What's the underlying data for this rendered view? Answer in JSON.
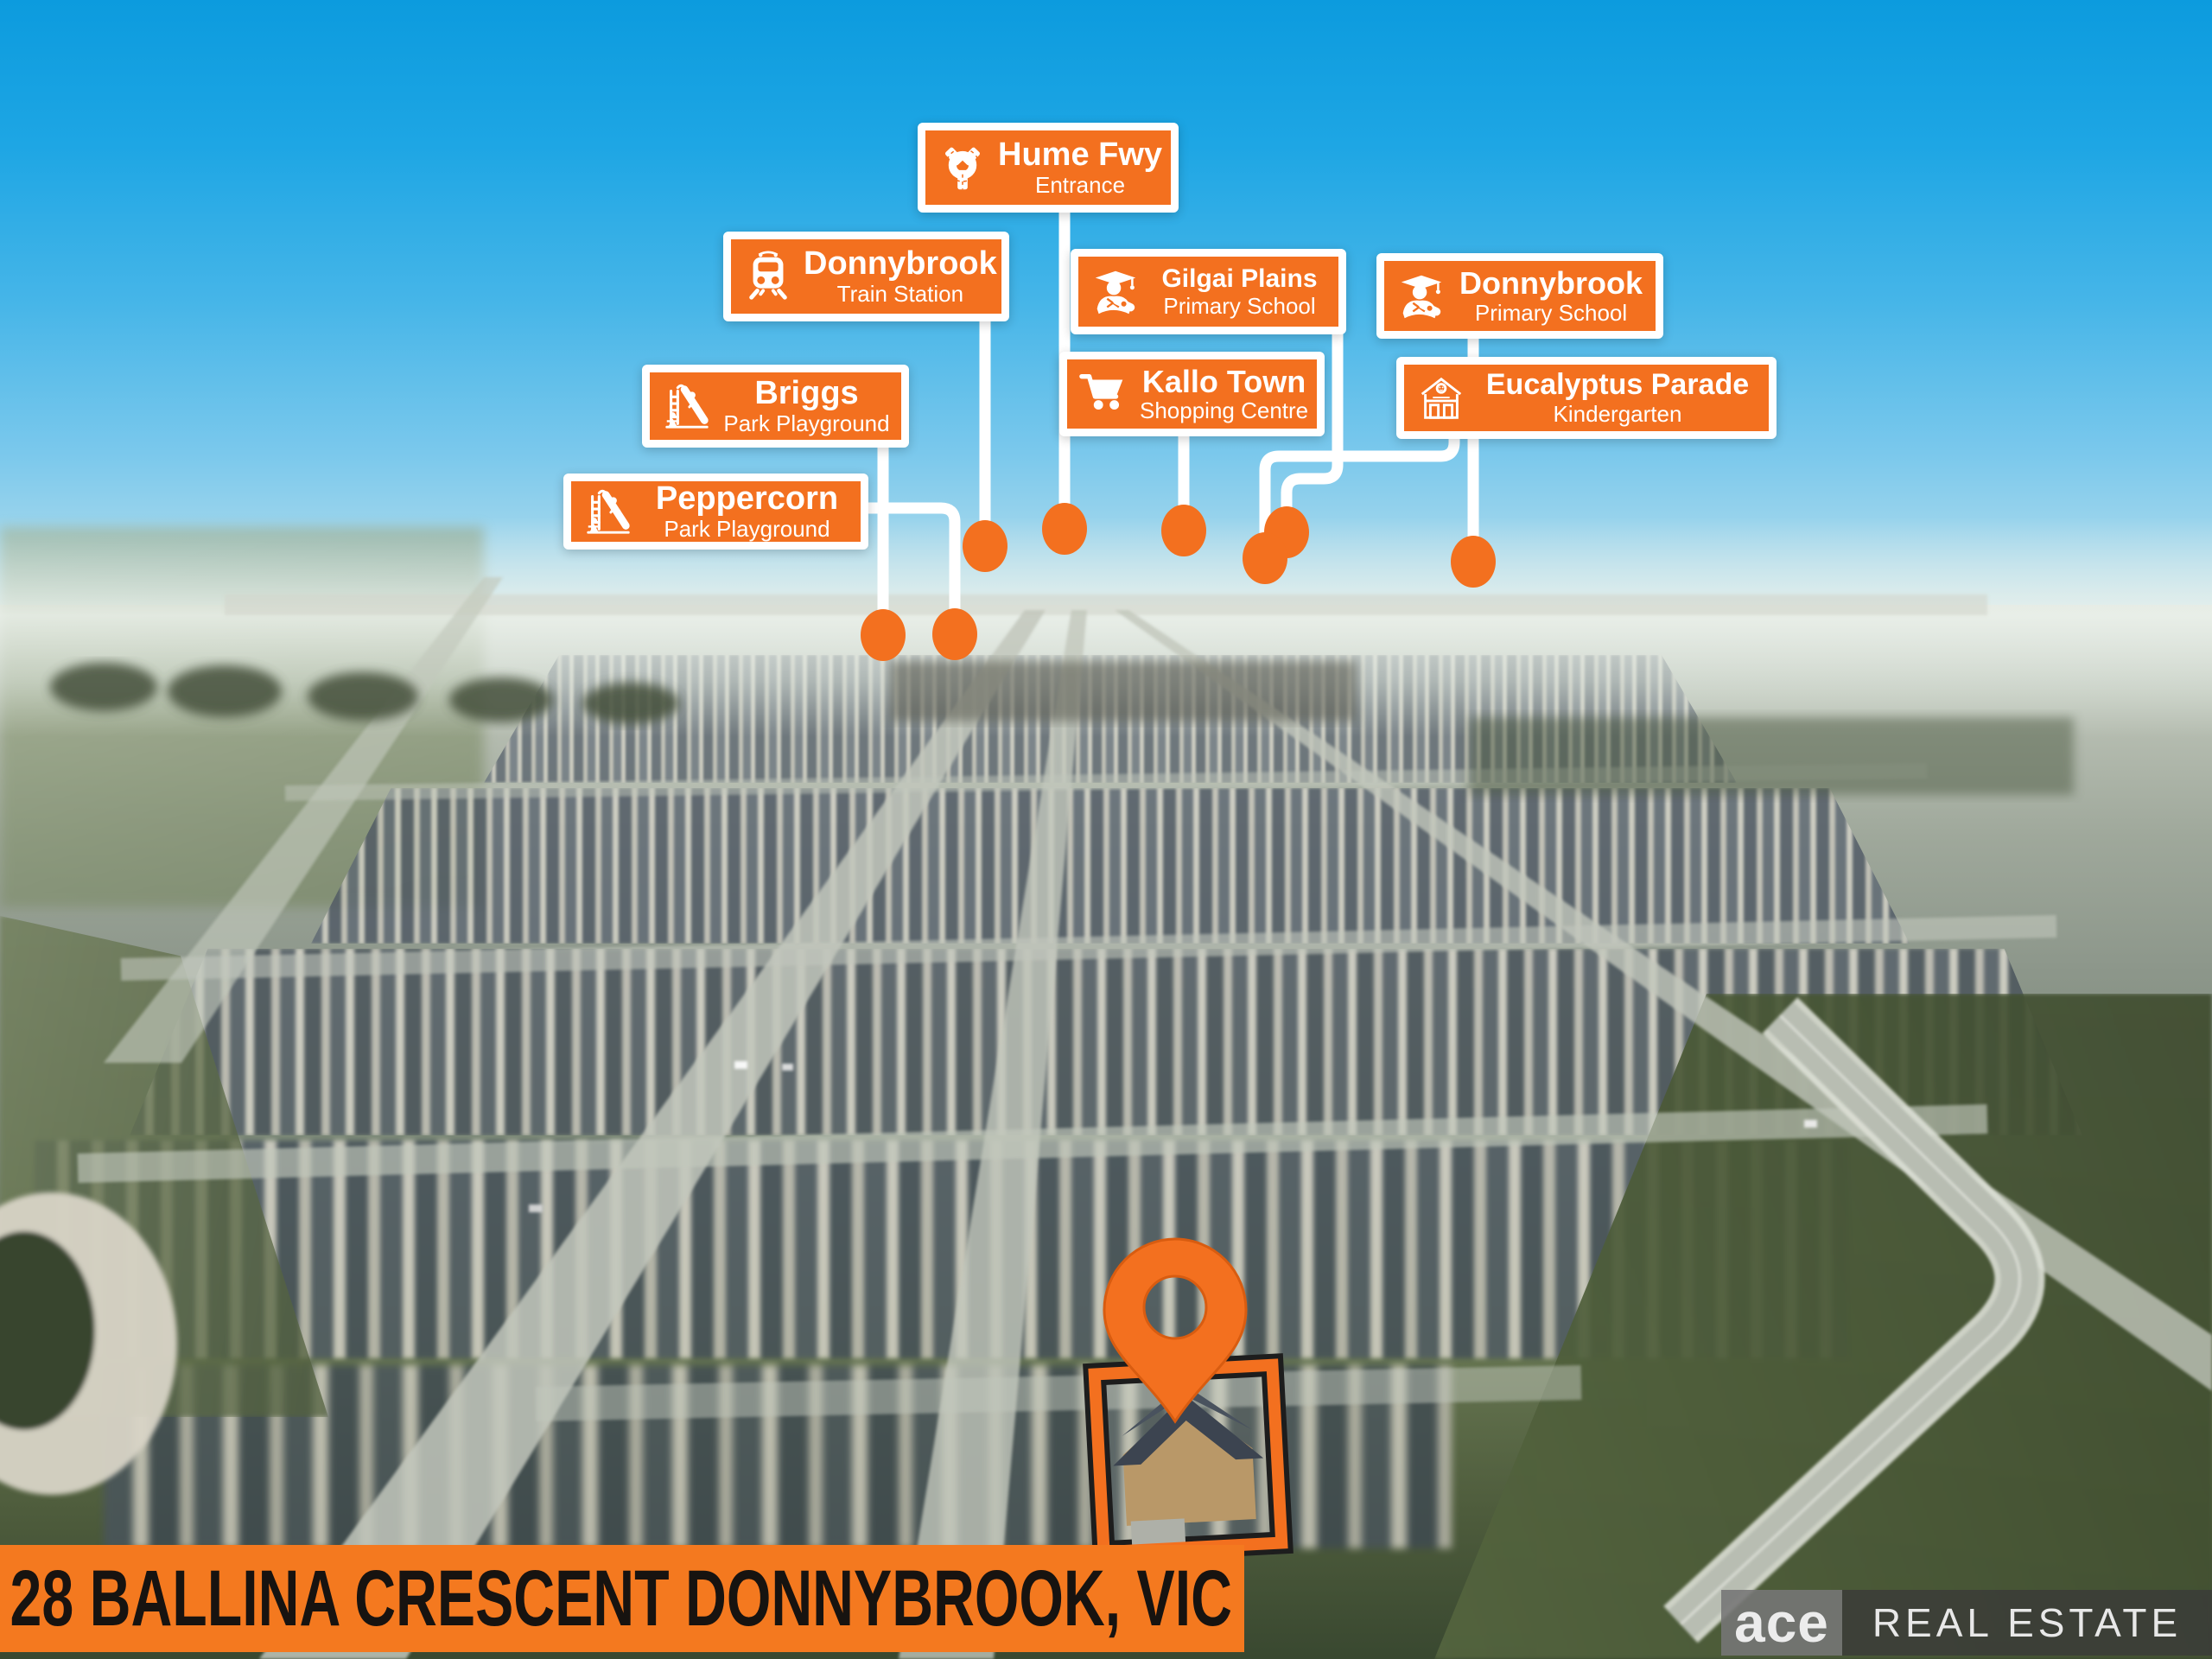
{
  "image_type": "real-estate aerial marketing photo",
  "callouts": [
    {
      "title": "Hume Fwy",
      "subtitle": "Entrance",
      "icon": "roundabout-icon"
    },
    {
      "title": "Donnybrook",
      "subtitle": "Train Station",
      "icon": "train-icon"
    },
    {
      "title": "Gilgai Plains",
      "subtitle": "Primary School",
      "icon": "graduate-icon"
    },
    {
      "title": "Donnybrook",
      "subtitle": "Primary School",
      "icon": "graduate-icon"
    },
    {
      "title": "Briggs",
      "subtitle": "Park Playground",
      "icon": "playground-slide-icon"
    },
    {
      "title": "Kallo Town",
      "subtitle": "Shopping Centre",
      "icon": "shopping-cart-icon"
    },
    {
      "title": "Eucalyptus Parade",
      "subtitle": "Kindergarten",
      "icon": "school-building-icon"
    },
    {
      "title": "Peppercorn",
      "subtitle": "Park Playground",
      "icon": "playground-slide-icon"
    }
  ],
  "address_banner": {
    "text": "28 BALLINA CRESCENT DONNYBROOK, VIC"
  },
  "brand": {
    "name": "ace",
    "suffix": "REAL ESTATE"
  },
  "property_marker": {
    "type": "map-pin",
    "color": "#F3701F",
    "frames_house": true
  },
  "palette": {
    "callout_orange": "#F3701F",
    "callout_border": "#FFFFFF",
    "connector_white": "#FFFFFF",
    "banner_orange": "#F4791F",
    "banner_text": "#171310",
    "sky_top": "#0C9BDE",
    "sky_horizon": "#D2E6E6",
    "field_green": "#45532F",
    "roof_gray": "#4E5864"
  }
}
